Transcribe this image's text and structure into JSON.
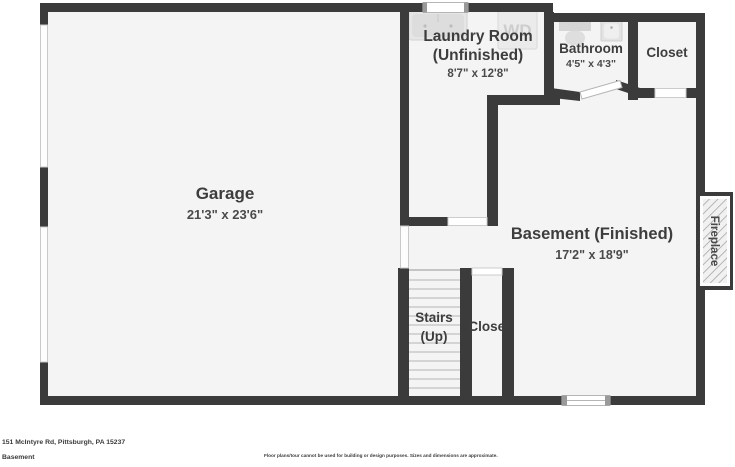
{
  "colors": {
    "wall": "#3b3b3b",
    "floor": "#f4f4f4",
    "fixture": "#e6e6e6",
    "fixture_dark": "#d9d9d9",
    "opening_stroke": "#c9c9c9",
    "text": "#3d3d3d"
  },
  "rooms": {
    "garage": {
      "label": "Garage",
      "dims": "21'3\" x 23'6\""
    },
    "laundry": {
      "label_line1": "Laundry Room",
      "label_line2": "(Unfinished)",
      "dims": "8'7\" x 12'8\""
    },
    "bathroom": {
      "label": "Bathroom",
      "dims": "4'5\" x 4'3\""
    },
    "closet_top": {
      "label": "Closet"
    },
    "basement": {
      "label": "Basement (Finished)",
      "dims": "17'2\" x 18'9\""
    },
    "stairs": {
      "label_line1": "Stairs",
      "label_line2": "(Up)"
    },
    "closet_bottom": {
      "label": "Closet"
    },
    "fireplace": {
      "label": "Fireplace"
    }
  },
  "fixtures": {
    "washer_dryer_label": "WD"
  },
  "footer": {
    "address": "151 McIntyre Rd, Pittsburgh, PA 15237",
    "floor_name": "Basement",
    "disclaimer": "Floor plans/tour cannot be used for building or design purposes. Sizes and dimensions are approximate."
  }
}
